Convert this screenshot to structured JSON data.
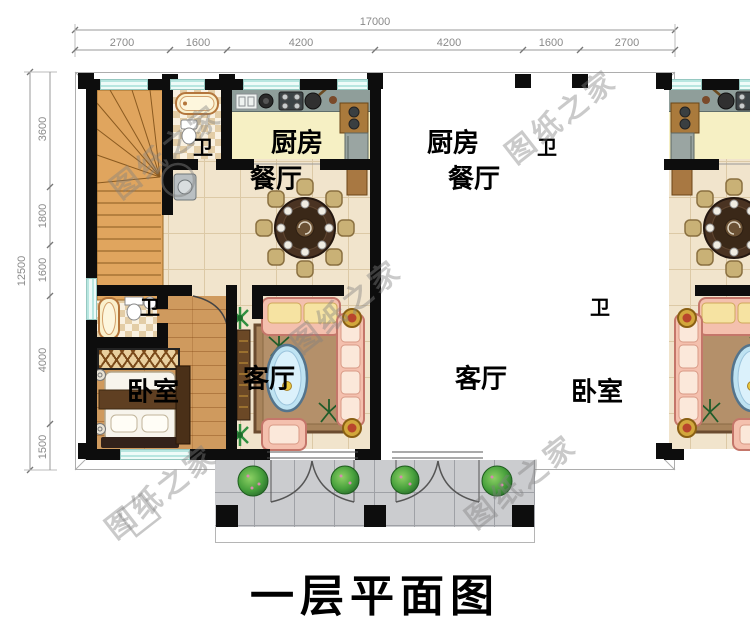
{
  "title": "一层平面图",
  "watermark_text": "图纸之家",
  "dimensions": {
    "top": {
      "total": "17000",
      "segments": [
        "2700",
        "1600",
        "4200",
        "4200",
        "1600",
        "2700"
      ]
    },
    "left": {
      "total": "12500",
      "segments": [
        "3600",
        "1800",
        "1600",
        "4000",
        "1500"
      ]
    }
  },
  "room_labels": {
    "kitchen": "厨房",
    "dining": "餐厅",
    "bathroom": "卫",
    "living": "客厅",
    "bedroom": "卧室"
  },
  "colors": {
    "wall": "#0d0d0d",
    "window": "#d9f3ef",
    "floor_tile": "#f1e4cc",
    "floor_wood": "#cf9a5e",
    "kitchen_floor": "#f6f0c4",
    "counter_gray": "#8f9e9a",
    "sofa_salmon": "#f4c0ae",
    "rug_brown": "#a8845c",
    "table_brown": "#46301e",
    "porch_gray": "#cbcccf",
    "bush_green": "#3f9a3f",
    "dimension_text": "#8a8a8a",
    "watermark_gray": "#9a9a9a"
  }
}
